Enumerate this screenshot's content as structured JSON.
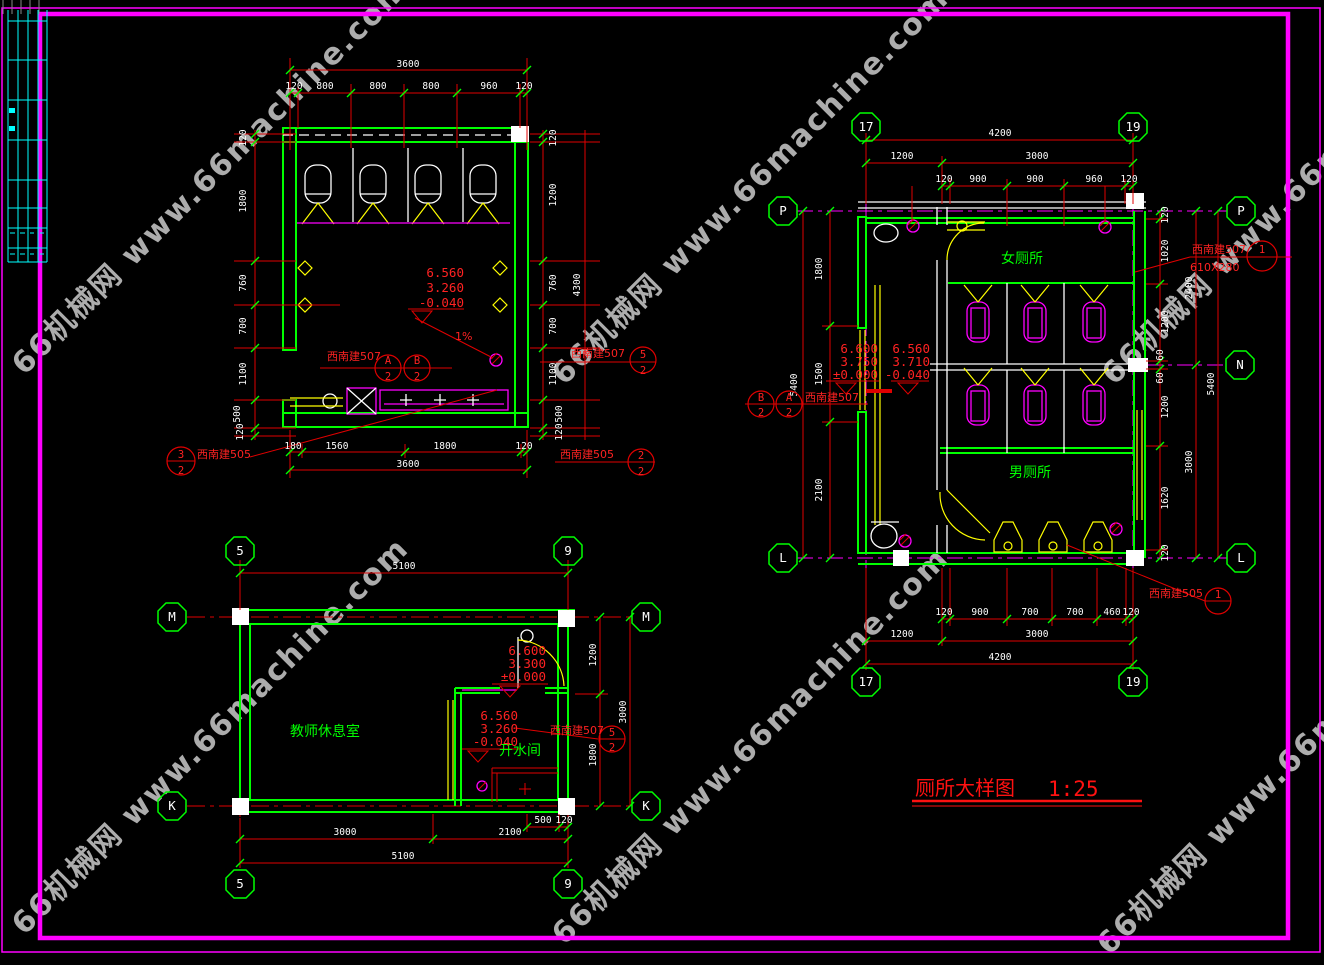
{
  "watermark": {
    "text": "66机械网 www.66machine.com"
  },
  "title": {
    "text": "厕所大样图",
    "scale": "1:25"
  },
  "colors": {
    "wall": "#00ff00",
    "dim": "#e00000",
    "frame": "#ff00ff",
    "fixture": "#ffff00",
    "annotation": "#ff2222"
  },
  "plan_top_left": {
    "dim_top_overall": "3600",
    "dim_top": [
      "120",
      "800",
      "800",
      "800",
      "960",
      "120"
    ],
    "dim_left": [
      "120",
      "1800",
      "760",
      "700",
      "1100",
      "500",
      "120"
    ],
    "dim_right": [
      "120",
      "1200",
      "760",
      "700",
      "1100",
      "500",
      "120"
    ],
    "dim_right_overall": "4300",
    "dim_bottom": [
      "180",
      "1560",
      "1800",
      "120"
    ],
    "dim_bottom_overall": "3600",
    "levels": [
      "6.560",
      "3.260",
      "-0.040"
    ],
    "slope": "1%",
    "refs": {
      "mid_label": "西南建507",
      "mid_a": "A",
      "mid_a_d": "2",
      "mid_b": "B",
      "mid_b_d": "2",
      "right_label": "西南建507",
      "right_n": "5",
      "right_d": "2",
      "bl_label": "西南建505",
      "bl_n": "3",
      "bl_d": "2",
      "br_label": "西南建505",
      "br_n": "2",
      "br_d": "2"
    }
  },
  "plan_right": {
    "grid": {
      "c17": "17",
      "c19": "19",
      "p": "P",
      "n": "N",
      "l": "L"
    },
    "rooms": {
      "women": "女厕所",
      "men": "男厕所"
    },
    "dim_top_overall": "4200",
    "dim_top_left": "1200",
    "dim_top_right": "3000",
    "dim_top_chain": [
      "120",
      "900",
      "900",
      "960",
      "120"
    ],
    "dim_bottom_chain": [
      "120",
      "900",
      "700",
      "700",
      "460",
      "120"
    ],
    "dim_bottom_left": "1200",
    "dim_bottom_right": "3000",
    "dim_bottom_overall": "4200",
    "dim_right_chain": [
      "120",
      "1020",
      "1200",
      "60",
      "60",
      "1200",
      "1620",
      "120"
    ],
    "dim_right_mid": [
      "2400",
      "3000"
    ],
    "dim_right_overall": "5400",
    "dim_left_chain": [
      "1800",
      "1500",
      "2100"
    ],
    "dim_left_overall": "5400",
    "levels_a": [
      "6.600",
      "3.750",
      "±0.000"
    ],
    "levels_b": [
      "6.560",
      "3.710",
      "-0.040"
    ],
    "refs": {
      "top_label": "西南建507",
      "top_n": "1",
      "top_size": "610X280",
      "mid_label": "西南建507",
      "mid_b": "B",
      "mid_b_d": "2",
      "mid_a": "A",
      "mid_a_d": "2",
      "bottom_label": "西南建505",
      "bottom_n": "1"
    }
  },
  "plan_bottom_left": {
    "grid": {
      "c5": "5",
      "c9": "9",
      "m": "M",
      "k": "K"
    },
    "rooms": {
      "lounge": "教师休息室",
      "boiler": "开水间"
    },
    "dim_top_overall": "5100",
    "dim_right": [
      "1200",
      "1800"
    ],
    "dim_right_overall": "3000",
    "dim_bottom_small": [
      "500",
      "120"
    ],
    "dim_bottom": [
      "3000",
      "2100"
    ],
    "dim_bottom_overall": "5100",
    "levels_a": [
      "6.600",
      "3.300",
      "±0.000"
    ],
    "levels_b": [
      "6.560",
      "3.260",
      "-0.040"
    ],
    "refs": {
      "label": "西南建507",
      "n": "5",
      "d": "2"
    }
  }
}
